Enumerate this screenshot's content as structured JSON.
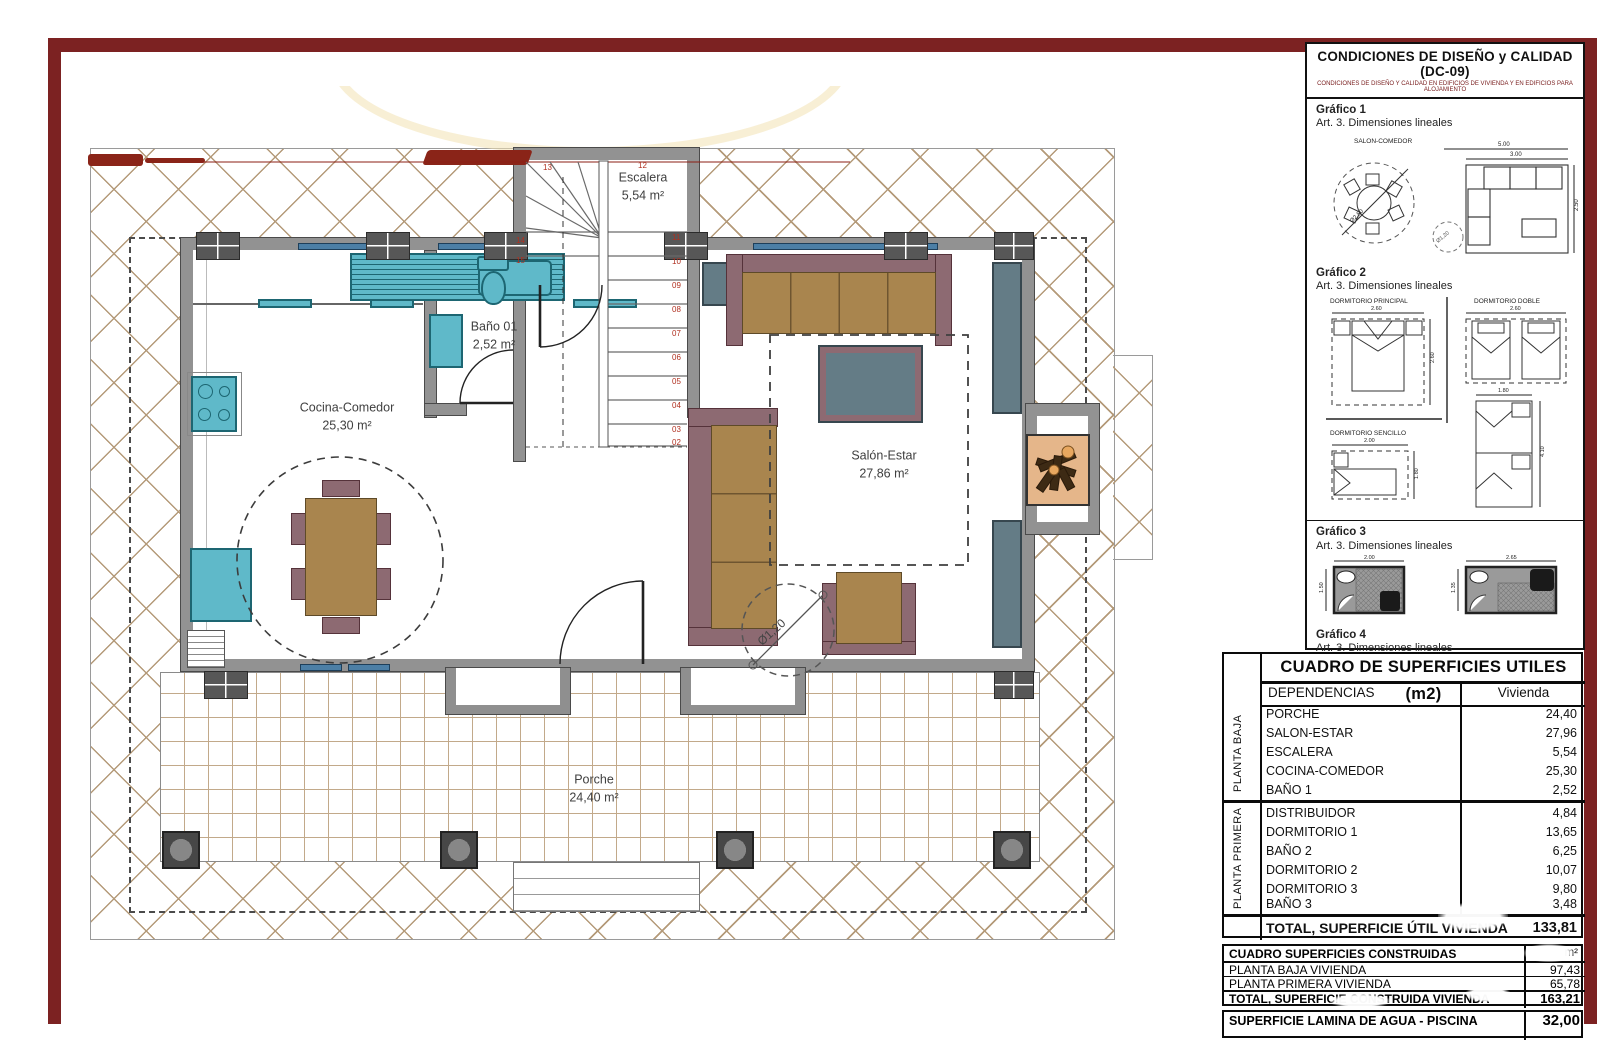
{
  "colors": {
    "frame": "#7c2222",
    "hatch_line": "#b49a79",
    "wall": "#929292",
    "teal": "#5fb9c9",
    "furniture_brown": "#a9854e",
    "furniture_mauve": "#8d6a72",
    "accent_blue": "#4c7fa6"
  },
  "plan": {
    "labels": {
      "escalera": {
        "name": "Escalera",
        "area": "5,54 m²"
      },
      "bano": {
        "name": "Baño 01",
        "area": "2,52 m²"
      },
      "cocina": {
        "name": "Cocina-Comedor",
        "area": "25,30 m²"
      },
      "salon": {
        "name": "Salón-Estar",
        "area": "27,86 m²"
      },
      "porche": {
        "name": "Porche",
        "area": "24,40 m²"
      },
      "circle": "Ø1,20"
    },
    "stairs": {
      "right": [
        "11",
        "10",
        "09",
        "08",
        "07",
        "06",
        "05",
        "04",
        "03",
        "02"
      ],
      "left": [
        "14",
        "15"
      ],
      "top": [
        "13",
        "12"
      ]
    }
  },
  "panel": {
    "title": "CONDICIONES DE DISEÑO y CALIDAD (DC-09)",
    "subtitle": "CONDICIONES DE DISEÑO Y CALIDAD EN EDIFICIOS DE VIVIENDA Y EN EDIFICIOS PARA ALOJAMIENTO",
    "art_line": "Art. 3. Dimensiones lineales",
    "g1": {
      "heading": "Gráfico 1",
      "room_label": "SALON-COMEDOR",
      "dim_a": "5.00",
      "dim_b": "3.00",
      "dim_side": "2.50",
      "dim_circle": "Ø2,50",
      "dim_circle_small": "Ø1,20"
    },
    "g2": {
      "heading": "Gráfico 2",
      "principal": "DORMITORIO PRINCIPAL",
      "doble": "DORMITORIO DOBLE",
      "sencillo": "DORMITORIO SENCILLO",
      "dim_principal_w": "2.60",
      "dim_principal_h": "2.60",
      "dim_doble_w": "2.60",
      "dim_sencillo_w": "2.00",
      "dim_sencillo_h": "1.80",
      "dim_twin_w": "1.80",
      "dim_twin_h": "4.10"
    },
    "g3": {
      "heading": "Gráfico 3",
      "dim_b1_w": "2.00",
      "dim_b1_h": "1.50",
      "dim_b2_w": "2.65",
      "dim_b2_h": "1.35"
    },
    "g4": {
      "heading": "Gráfico 4",
      "dim": "0.70",
      "dim2": "0.60",
      "dim3": "0.80",
      "apart": "APART.",
      "zona_aparato": "ZONA DE APARATO",
      "zona_uso": "ZONA DE USO"
    }
  },
  "tables": {
    "useful": {
      "title": "CUADRO DE SUPERFICIES UTILES (m2)",
      "col_dep": "DEPENDENCIAS",
      "col_viv": "Vivienda",
      "group1": "PLANTA BAJA",
      "group2": "PLANTA PRIMERA",
      "rows": [
        {
          "name": "PORCHE",
          "value": "24,40"
        },
        {
          "name": "SALON-ESTAR",
          "value": "27,96"
        },
        {
          "name": "ESCALERA",
          "value": "5,54"
        },
        {
          "name": "COCINA-COMEDOR",
          "value": "25,30"
        },
        {
          "name": "BAÑO 1",
          "value": "2,52"
        },
        {
          "name": "DISTRIBUIDOR",
          "value": "4,84"
        },
        {
          "name": "DORMITORIO 1",
          "value": "13,65"
        },
        {
          "name": "BAÑO 2",
          "value": "6,25"
        },
        {
          "name": "DORMITORIO 2",
          "value": "10,07"
        },
        {
          "name": "DORMITORIO 3",
          "value": "9,80"
        },
        {
          "name": "BAÑO 3",
          "value": "3,48"
        }
      ],
      "total_label": "TOTAL, SUPERFICIE ÚTIL VIVIENDA",
      "total_value": "133,81"
    },
    "built": {
      "title": "CUADRO SUPERFICIES CONSTRUIDAS",
      "unit": "m²",
      "rows": [
        {
          "name": "PLANTA BAJA VIVIENDA",
          "value": "97,43"
        },
        {
          "name": "PLANTA PRIMERA VIVIENDA",
          "value": "65,78"
        }
      ],
      "total_label": "TOTAL, SUPERFICIE CONSTRUIDA VIVIENDA",
      "total_value": "163,21"
    },
    "pool": {
      "label": "SUPERFICIE LAMINA DE AGUA - PISCINA",
      "value": "32,00"
    }
  }
}
